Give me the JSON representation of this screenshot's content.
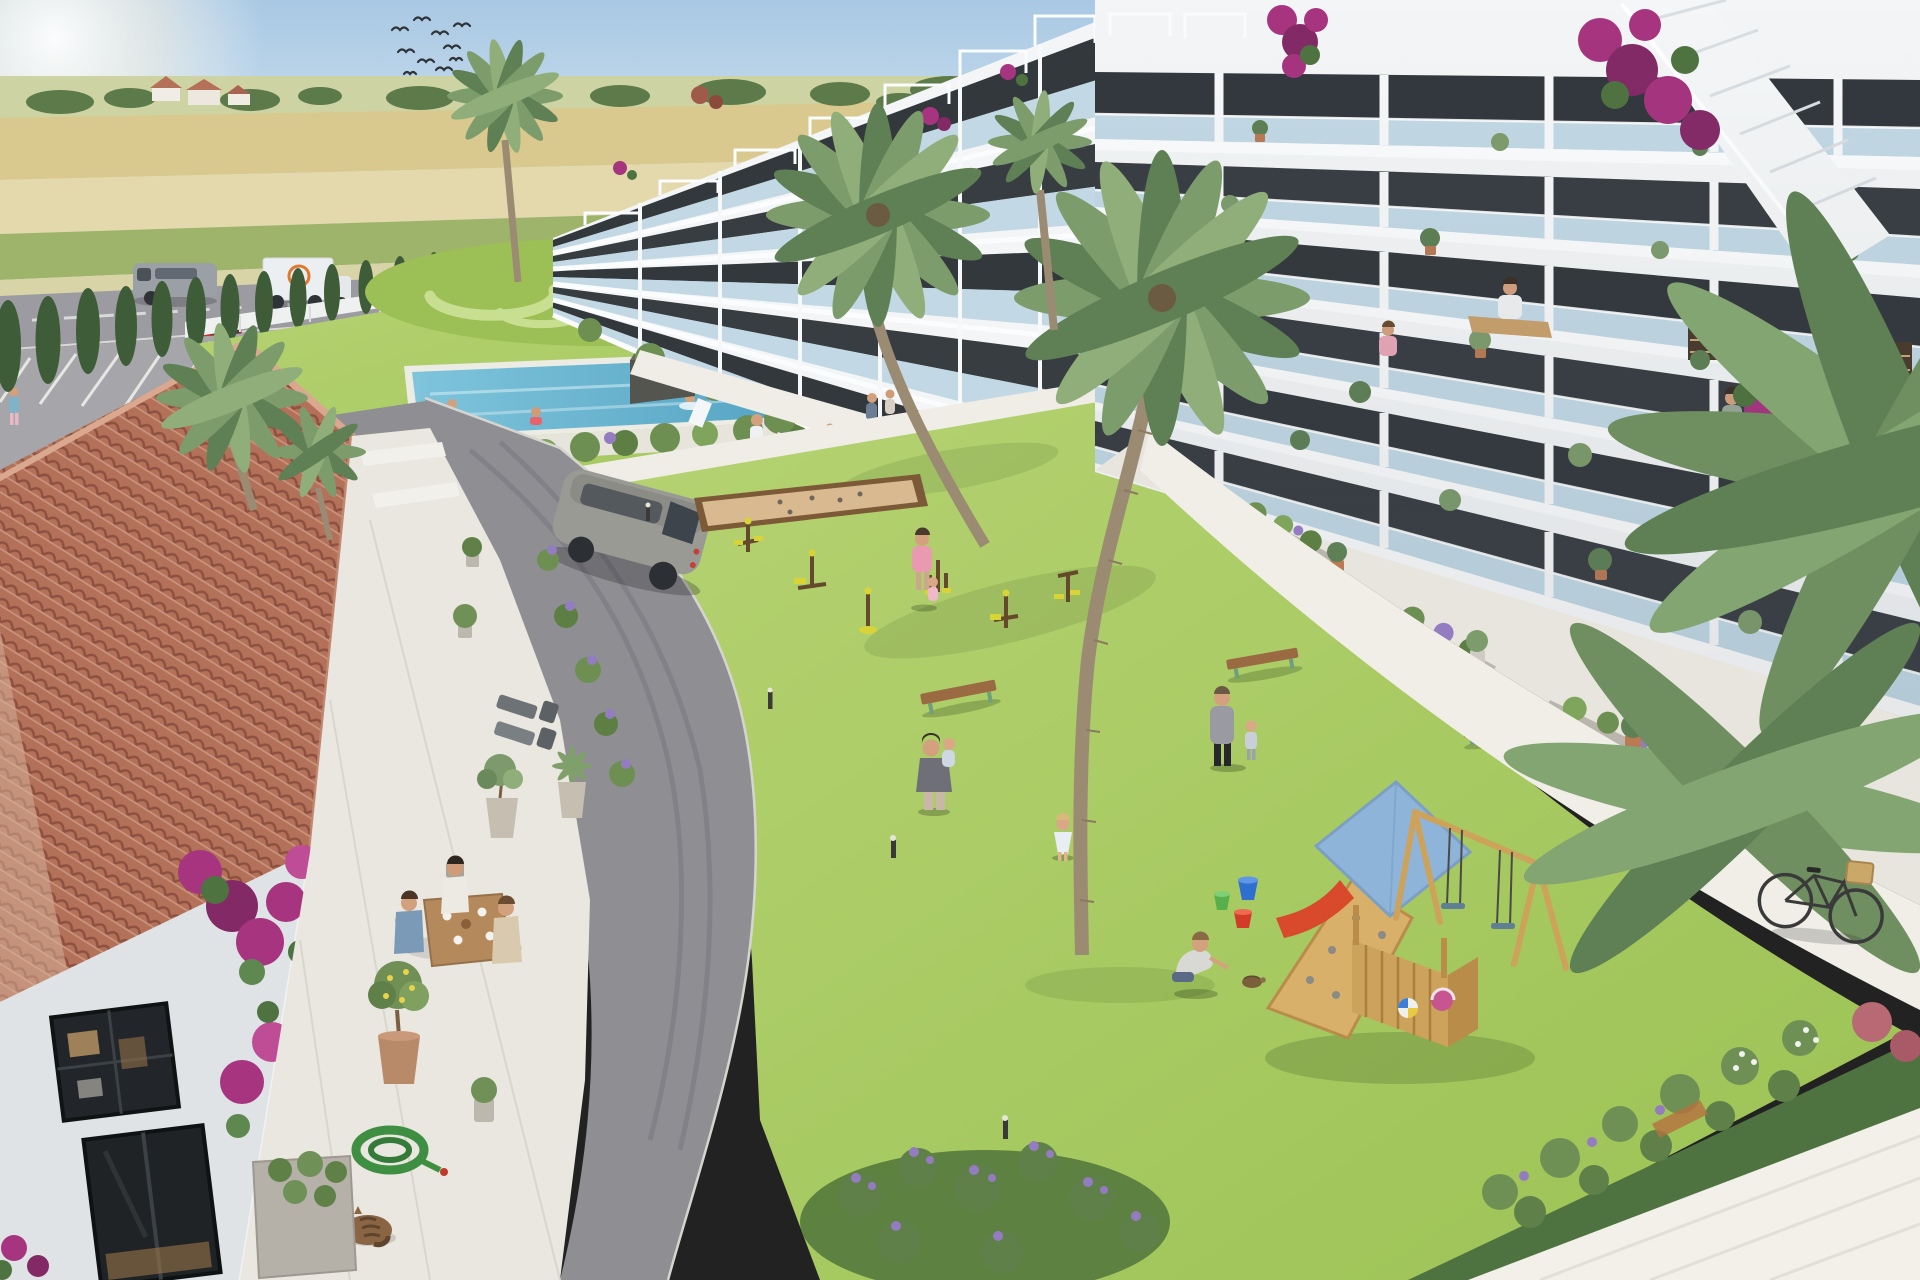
{
  "image": {
    "kind": "3D architectural rendering (photoreal aerial view)",
    "subject": "Courtyard of a new-build Mediterranean apartment complex beside farmland",
    "width": 1920,
    "height": 1280,
    "lighting": "bright sunny day, sun glare upper-left, long soft shadows"
  },
  "scene": {
    "sky": "clear pale blue sky with sun glare in upper-left corner and a small flock of birds",
    "background": "flat golden farm fields, distant farmhouses and tree line, country road with a grey van and a white delivery truck, row of dark cypress trees along the white perimeter fence",
    "left_foreground_building": "clubhouse with large terracotta tile roof, white walls, dark framed windows, magenta bougainvillea, terrace with three people at a breakfast table, potted lemon tree, coiled green garden hose, sleeping tabby cat, potted olive and agave, stone planter trough",
    "apartment_blocks": "two long modern white blocks with stepped glass balconies, rooftop pergolas, external white staircase, bougainvillea on parapets, residents on balconies (man at laptop table, seated woman, man watering plants), bookshelves behind windows, potted plants on every level",
    "courtyard": "large sunlit lawn with rectangular swimming pool and swimmers, ornamental mowed lawn, petanque sand court, outdoor gym with yellow seats, three wooden benches, kids playground (blue-roof wooden tower, red slide, climbing ramp, double swing), colourful buckets and beach balls, boy crouching beside a tortoise, families with children, white walkways, bollard lights, parked bicycle with wicker basket, silver SUV on internal asphalt road, red parked car, lavender beds and flowering shrubs"
  },
  "inventory": {
    "birds": 10,
    "people_total_approx": 21,
    "swimmers": 3,
    "terrace_diners": 3,
    "balcony_residents": 3,
    "vehicles": [
      "grey van",
      "white box truck",
      "red car",
      "silver SUV"
    ],
    "bicycles": 1,
    "animals": [
      "tabby cat",
      "tortoise"
    ],
    "benches": 3,
    "gym_stations": 6,
    "buckets": 3,
    "play_balls": 2,
    "palm_trees_approx": 10,
    "cypress_trees_approx": 20,
    "bollard_lights": 4
  },
  "colors": {
    "sky_top": "#a9c8e3",
    "sky_mid": "#d7e8f3",
    "sky_horizon": "#eef3f0",
    "field_far": "#cdd3a2",
    "field_gold": "#d9c98e",
    "field_straw": "#e4d9ad",
    "field_green": "#9fb46b",
    "treeline": "#5d7a4a",
    "road": "#9b9ba1",
    "parking": "#a6a6aa",
    "internal_road": "#8f8f93",
    "tire_mark": "#797980",
    "fence_white": "#eff1f0",
    "cypress": "#3e5c37",
    "lawn_light": "#b6d373",
    "lawn": "#9cc254",
    "mow_light": "#c8df92",
    "mow_dark": "#83af47",
    "pool_shallow": "#7fc4db",
    "pool_deep": "#3e93b8",
    "deck_wood": "#c7a87c",
    "hedge": "#6d9052",
    "lavender": "#947cc0",
    "bougainvillea": "#a6347f",
    "bougainvillea_deep": "#832a66",
    "roof_tile": "#b3715a",
    "roof_tile_light": "#cb947d",
    "roof_tile_dark": "#8e5140",
    "roof_ridge": "#d9a88f",
    "clubhouse_wall": "#dfe3e6",
    "window_dark": "#33383d",
    "terrace_stone": "#e9e7e0",
    "planter_concrete": "#bab6ad",
    "facade": "#f3f5f6",
    "slab": "#fbfcfd",
    "glass": "#b9d4e2",
    "palm_leaf": "#7d9c6c",
    "palm_leaf_dark": "#5e8054",
    "palm_trunk": "#9c8b73",
    "sand_court": "#d9ba90",
    "court_wood": "#7c5a38",
    "play_wood": "#cda35c",
    "play_roof": "#8fb4d9",
    "slide_red": "#d84a2b",
    "swing_seat": "#5f7f95",
    "bench_wood": "#9a6b42",
    "bench_leg": "#6f9f7c",
    "gym_frame": "#64492c",
    "gym_accent": "#d8d437",
    "bucket_green": "#57b04b",
    "bucket_blue": "#2f6fd0",
    "bucket_red": "#d23b28",
    "ball_blue": "#3f7fd9",
    "ball_yellow": "#e8c93f",
    "ball_pink": "#c75590",
    "suv_silver": "#9a9a94",
    "van_grey": "#9aa0a6",
    "truck_white": "#eceff1",
    "truck_logo": "#e07830",
    "car_red": "#c2332c",
    "bike_frame": "#3a3a3a",
    "basket": "#c9a86a",
    "cat_fur": "#8a6544",
    "skin": "#d4a17e"
  }
}
